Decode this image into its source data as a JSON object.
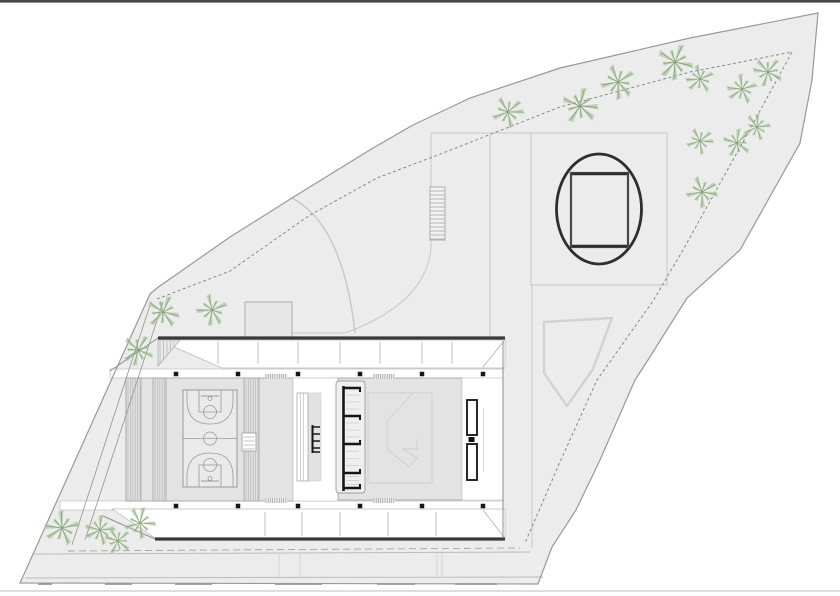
{
  "title": "Architectural site plan — sports hall with running-track plaza",
  "canvas": {
    "w": 840,
    "h": 596
  },
  "colors": {
    "bg": "#ffffff",
    "site": "#ececec",
    "siteStroke": "#999999",
    "inner": "#7f7f7f",
    "faint": "#c7c7c7",
    "faint2": "#d4d4d4",
    "dark": "#3a3a3a",
    "black": "#161616",
    "hall": "#e3e3e3",
    "court": "#eaeaea",
    "courtLine": "#9b9b9b",
    "hatch": "#b5b5b5",
    "hatchDark": "#8a8a8a",
    "band": "#ffffff",
    "bandEdge": "#c6c6c6",
    "road": "#bcbcbc",
    "roadDash": "#a4a4a4",
    "green1": "#a5c596",
    "green2": "#7d9f6d",
    "box": "#e7e7e7",
    "boxStroke": "#adadad",
    "pent": "#d2d2d2",
    "topBand": "#474747",
    "bottomLine": "#c9c9c9"
  },
  "page": {
    "top_band_h": 2.6,
    "bottom_line_y": 591
  },
  "site": {
    "outer": [
      [
        818,
        13
      ],
      [
        690,
        38
      ],
      [
        560,
        68
      ],
      [
        470,
        98
      ],
      [
        413,
        125
      ],
      [
        373,
        148
      ],
      [
        292,
        198
      ],
      [
        230,
        237
      ],
      [
        157,
        288
      ],
      [
        150,
        294
      ],
      [
        20,
        583
      ],
      [
        538,
        584
      ],
      [
        552,
        547
      ],
      [
        576,
        510
      ],
      [
        600,
        460
      ],
      [
        635,
        380
      ],
      [
        648,
        360
      ],
      [
        687,
        298
      ],
      [
        740,
        250
      ],
      [
        800,
        143
      ],
      [
        812,
        80
      ]
    ],
    "inner": [
      [
        157,
        299
      ],
      [
        230,
        271
      ],
      [
        310,
        215
      ],
      [
        377,
        178
      ],
      [
        438,
        155
      ],
      [
        560,
        107
      ],
      [
        690,
        72
      ],
      [
        792,
        52
      ],
      [
        744,
        140
      ],
      [
        683,
        250
      ],
      [
        653,
        301
      ],
      [
        597,
        380
      ],
      [
        560,
        462
      ],
      [
        525,
        543
      ]
    ],
    "left_path_lines": [
      [
        150,
        305,
        72,
        545
      ],
      [
        163,
        302,
        85,
        540
      ]
    ]
  },
  "plaza": {
    "lines": [
      [
        431,
        133,
        531,
        133
      ],
      [
        490,
        135,
        490,
        337
      ],
      [
        532,
        285,
        532,
        548
      ],
      [
        531,
        285,
        657,
        285
      ]
    ],
    "rect": [
      531,
      133,
      136,
      152
    ],
    "curve": "M292,198 C330,218 348,270 355,333",
    "curve2": "M431,133 L431,247 Q427,303 345,333 L292,333",
    "box": [
      245,
      302,
      47,
      35
    ],
    "stairs": {
      "x": 430,
      "y": 187,
      "w": 15,
      "h": 53,
      "step": 4
    },
    "pentagon": [
      [
        544,
        322
      ],
      [
        612,
        318
      ],
      [
        593,
        369
      ],
      [
        567,
        406
      ],
      [
        544,
        373
      ]
    ],
    "ellipse": {
      "cx": 599,
      "cy": 209,
      "rx": 42.5,
      "ry": 55
    },
    "track_rect": [
      571,
      173,
      57,
      74
    ]
  },
  "building": {
    "roof_w": 3.2,
    "roof_lines": [
      [
        158,
        338,
        505,
        338
      ],
      [
        155,
        539,
        505,
        539
      ]
    ],
    "band_top": {
      "poly": [
        [
          158,
          340
        ],
        [
          505,
          340
        ],
        [
          505,
          368
        ],
        [
          222,
          368
        ]
      ],
      "diag": [
        483,
        367,
        504,
        341
      ],
      "ticks_x": [
        218,
        258,
        298,
        340,
        380,
        422,
        452
      ],
      "tick_y": [
        342,
        364
      ],
      "tri": [
        [
          158,
          340
        ],
        [
          180,
          340
        ],
        [
          158,
          366
        ]
      ]
    },
    "band_bottom": {
      "poly": [
        [
          112,
          509
        ],
        [
          505,
          509
        ],
        [
          505,
          538
        ],
        [
          155,
          538
        ]
      ],
      "diag": [
        483,
        510,
        504,
        537
      ],
      "ticks_x": [
        265,
        302,
        340,
        388,
        436
      ],
      "tick_y": [
        512,
        536
      ]
    },
    "walk_top": [
      110,
      369,
      393,
      9
    ],
    "walk_bottom": [
      60,
      501,
      443,
      9
    ],
    "halls": {
      "left": [
        126,
        378,
        167,
        123
      ],
      "corridor": [
        293,
        378,
        45,
        123
      ],
      "right": [
        338,
        378,
        124,
        122
      ],
      "right_wall": [
        462,
        378,
        41,
        122
      ]
    },
    "right_edge": [
      503,
      341,
      503,
      538
    ],
    "closures": [
      [
        158,
        338,
        110,
        371
      ],
      [
        155,
        539,
        103,
        516
      ]
    ],
    "bleachers": [
      [
        126,
        378,
        15,
        123
      ],
      [
        153,
        378,
        13,
        123
      ],
      [
        244,
        378,
        15,
        123
      ]
    ],
    "tabs": [
      [
        265,
        374,
        22,
        5
      ],
      [
        373,
        374,
        22,
        5
      ],
      [
        265,
        498,
        22,
        5
      ],
      [
        373,
        498,
        22,
        5
      ]
    ],
    "columns": {
      "xs": [
        176,
        238,
        298,
        360,
        422,
        483
      ],
      "ys": [
        374,
        506
      ],
      "size": 4.5
    },
    "scorer": {
      "rect": [
        242,
        433,
        14,
        18
      ],
      "lines_y": [
        437,
        441,
        445,
        449
      ]
    },
    "ramp": {
      "rect": [
        297,
        393,
        11,
        88
      ],
      "inner_x": [
        300.5,
        303.5
      ],
      "side": [
        308,
        393,
        13,
        88
      ]
    },
    "mini_ladder": {
      "bar": [
        312.5,
        425,
        312.5,
        453
      ],
      "rungs_y": [
        427,
        434,
        441,
        448,
        452
      ],
      "x2": 320
    },
    "ladder": {
      "box": [
        336,
        381,
        29,
        112
      ],
      "bar_x": 343.5,
      "bar_y": [
        386,
        491
      ],
      "rungs_y": [
        388,
        416,
        444,
        473,
        488
      ],
      "x2": 361,
      "thin_x": [
        346,
        359
      ]
    },
    "stage_rect": [
      368,
      393,
      64,
      90
    ],
    "stage_path": "M413,393 L387,421 L387,449 L409,467 L417,458 L403,449 L417,449 L417,439",
    "brackets": {
      "rects": [
        [
          467,
          400,
          10,
          35
        ],
        [
          467,
          444,
          10,
          36
        ]
      ],
      "mid": [
        468.5,
        437,
        6,
        5
      ],
      "vline": [
        483.5,
        408,
        483.5,
        472
      ]
    }
  },
  "court": {
    "rect": [
      183,
      390,
      54,
      97
    ],
    "center_r": 6.5,
    "key_w": 22,
    "key_h": 22,
    "ft_r": 6.5,
    "bb_halfw": 9,
    "bb_off": 6,
    "hoop_off": 8.5,
    "hoop_r": 2,
    "three_d1": 10,
    "three_depth": 34,
    "three_inset": 4
  },
  "roads": {
    "dashed": [
      68,
      551,
      520,
      548
    ],
    "lines": [
      [
        33,
        554,
        530,
        552
      ],
      [
        25,
        578,
        543,
        577
      ]
    ],
    "center_dashes": {
      "y": 584,
      "segs": [
        [
          38,
          52
        ],
        [
          105,
          132
        ],
        [
          175,
          212
        ],
        [
          275,
          322
        ],
        [
          377,
          415
        ],
        [
          455,
          497
        ]
      ]
    },
    "verticals": [
      [
        279,
        554,
        279,
        577
      ],
      [
        300,
        554,
        300,
        577
      ],
      [
        437,
        553,
        437,
        577
      ],
      [
        442,
        553,
        442,
        577
      ]
    ]
  },
  "trees": {
    "items": [
      [
        508,
        112,
        1.0
      ],
      [
        580,
        106,
        1.15
      ],
      [
        618,
        82,
        1.1
      ],
      [
        675,
        62,
        1.15
      ],
      [
        700,
        79,
        0.9
      ],
      [
        742,
        89,
        0.95
      ],
      [
        768,
        72,
        0.95
      ],
      [
        757,
        127,
        0.85
      ],
      [
        737,
        143,
        0.9
      ],
      [
        700,
        141,
        0.85
      ],
      [
        702,
        192,
        1.0
      ],
      [
        163,
        312,
        1.05
      ],
      [
        212,
        310,
        1.0
      ],
      [
        138,
        350,
        1.0
      ],
      [
        62,
        528,
        1.1
      ],
      [
        100,
        530,
        0.95
      ],
      [
        118,
        541,
        0.85
      ],
      [
        140,
        523,
        1.0
      ]
    ]
  }
}
